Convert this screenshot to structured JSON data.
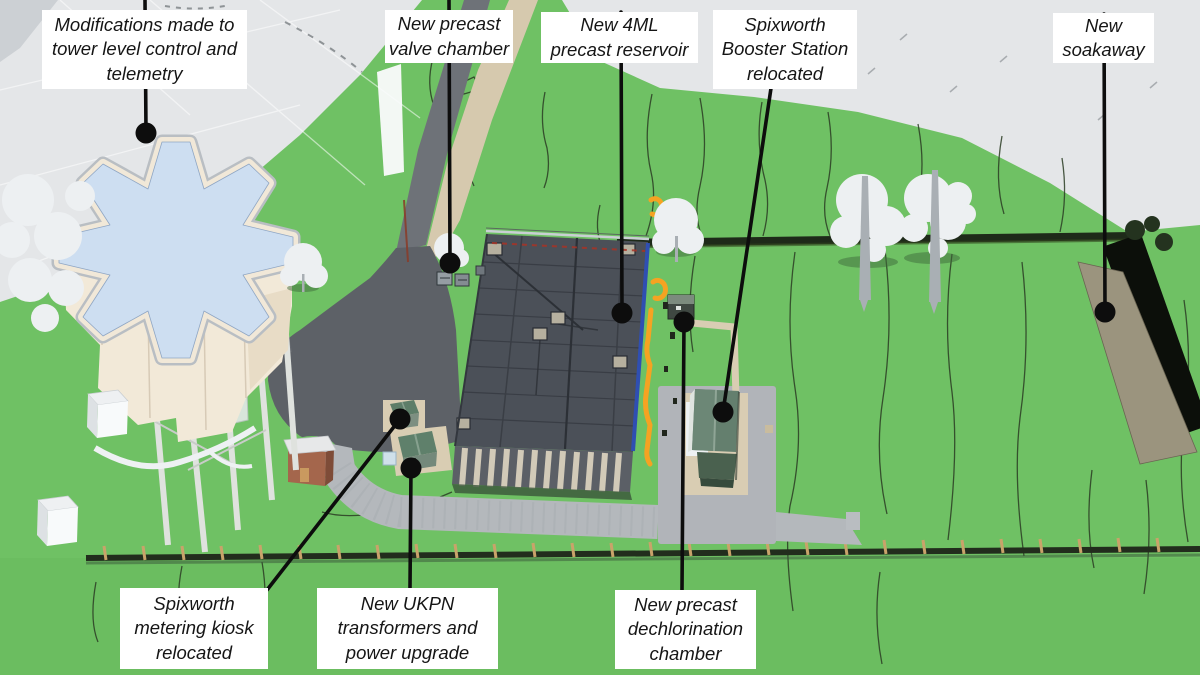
{
  "annotations": [
    {
      "id": "tower",
      "lines": [
        "Modifications made to",
        "tower level control and",
        "telemetry"
      ]
    },
    {
      "id": "valve-chamber",
      "lines": [
        "New precast",
        "valve chamber"
      ]
    },
    {
      "id": "reservoir",
      "lines": [
        "New 4ML",
        "precast reservoir"
      ]
    },
    {
      "id": "booster-station",
      "lines": [
        "Spixworth",
        "Booster Station",
        "relocated"
      ]
    },
    {
      "id": "soakaway",
      "lines": [
        "New",
        "soakaway"
      ]
    },
    {
      "id": "metering-kiosk",
      "lines": [
        "Spixworth",
        "metering kiosk",
        "relocated"
      ]
    },
    {
      "id": "ukpn",
      "lines": [
        "New UKPN",
        "transformers and",
        "power upgrade"
      ]
    },
    {
      "id": "dechlorination",
      "lines": [
        "New precast",
        "dechlorination",
        "chamber"
      ]
    }
  ],
  "colors": {
    "grass": "#6fc164",
    "field_gray": "#e4e6e8",
    "label_bg": "#ffffff",
    "label_text": "#151515",
    "leader_line": "#0d0d0d",
    "reservoir_roof": "#4b5058",
    "reservoir_stripe": "#d2cab8",
    "pipe_orange": "#f5a322",
    "pipe_blue": "#2f4fb2",
    "tower_top_blue": "#cddef1",
    "tower_body_cream": "#f2e9d8",
    "booster_roof_green": "#647f6e",
    "gravel": "#b4b8bc",
    "asphalt": "#5d6167",
    "path_beige": "#d6c9ae",
    "soakaway_tan": "#9b947e",
    "trench_black": "#0c0f0a",
    "hedge_dark": "#1e2a19",
    "fence_post_tan": "#c9a36a"
  },
  "markers": {
    "dot_style": "black-circle",
    "count": 8
  }
}
